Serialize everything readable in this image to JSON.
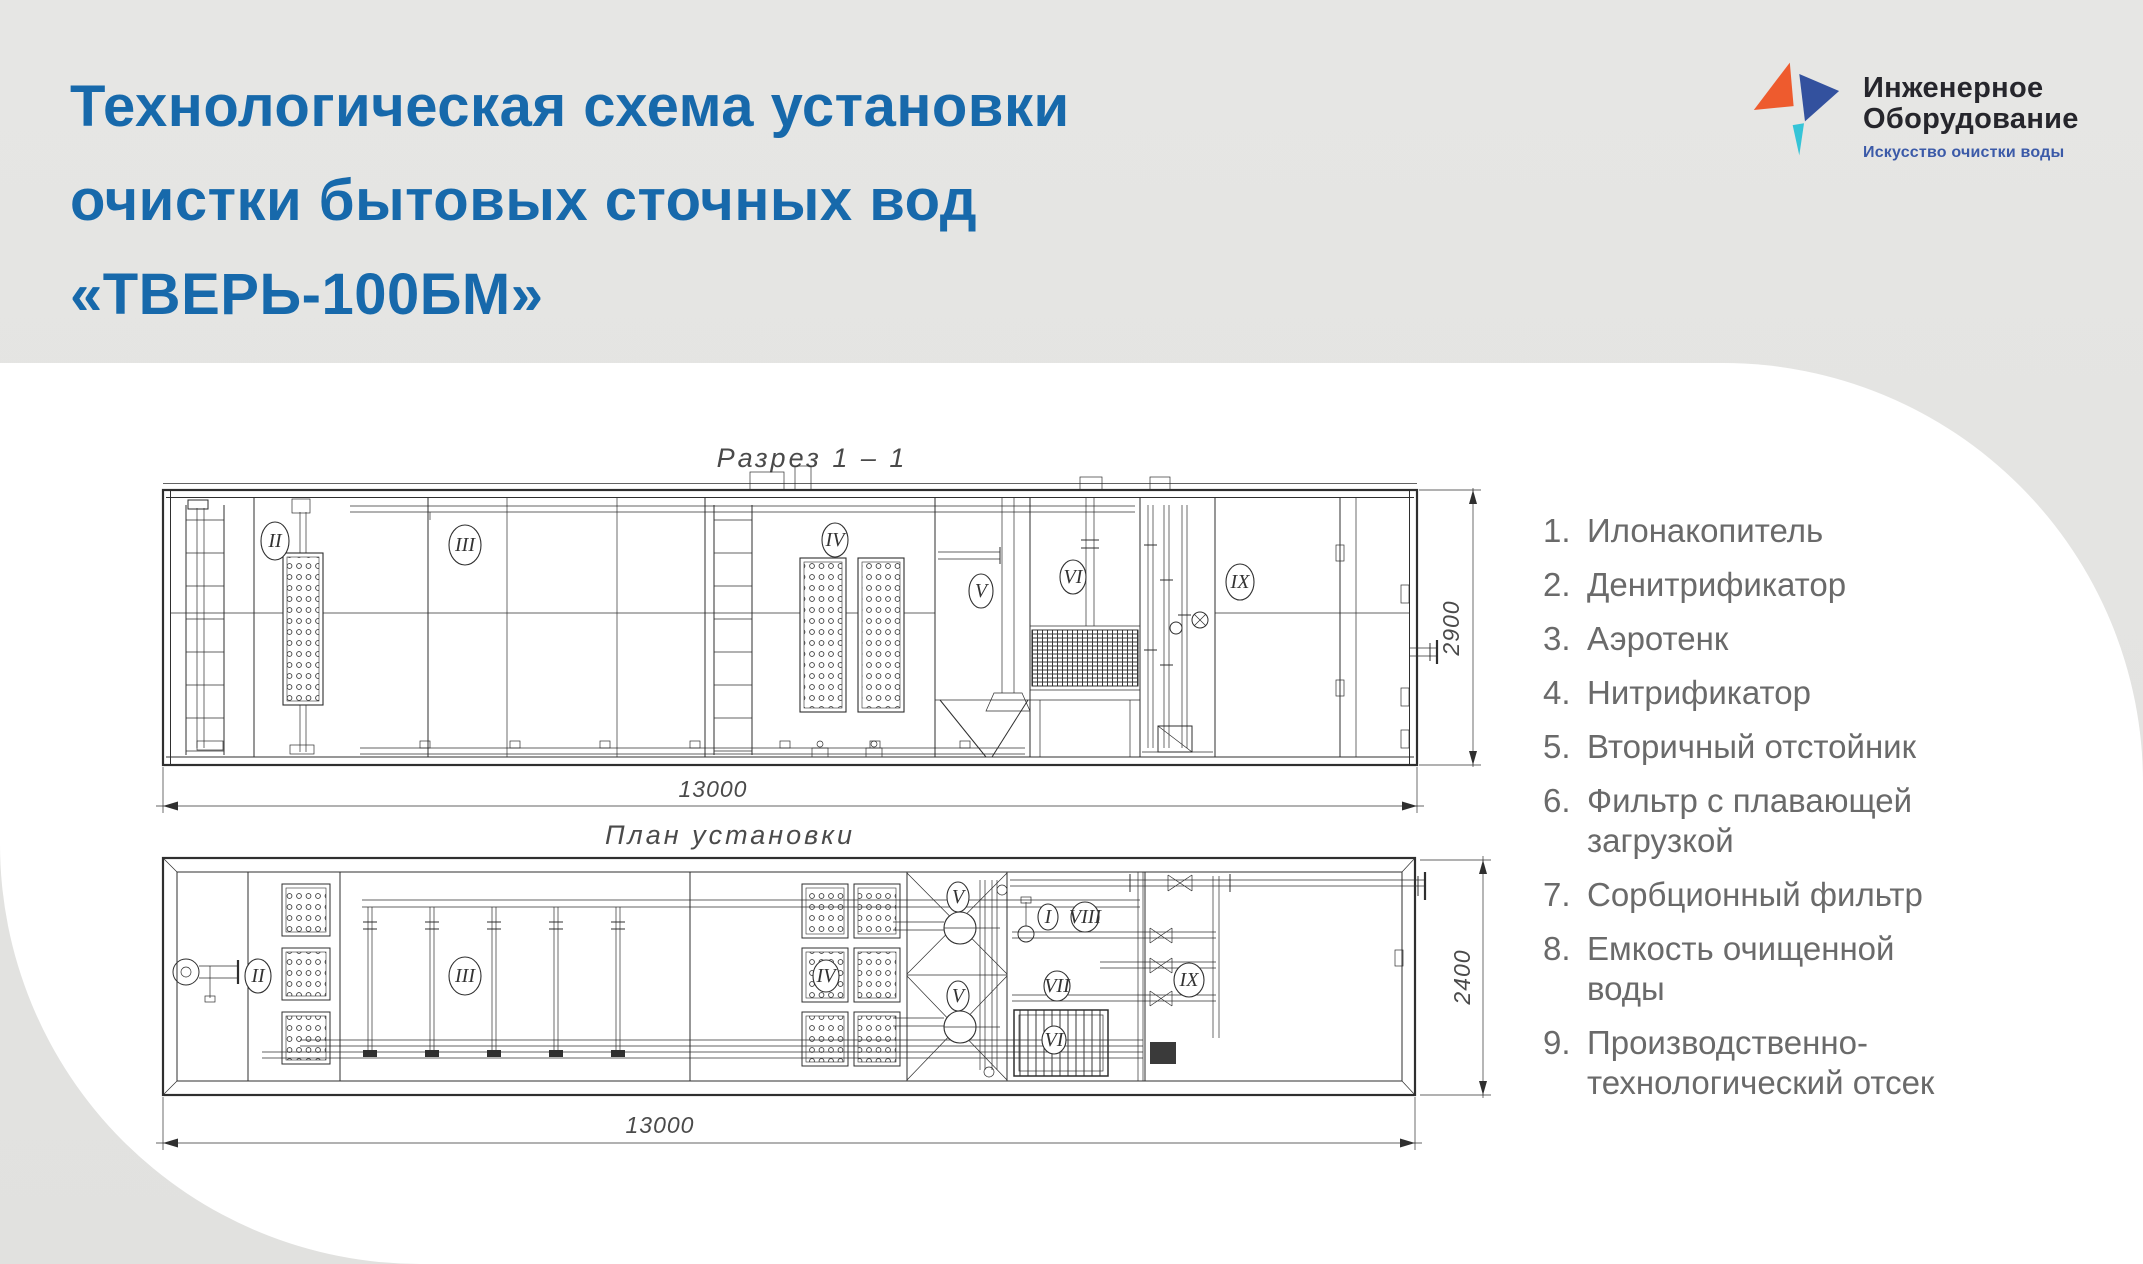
{
  "header": {
    "title_lines": [
      "Технологическая схема установки",
      "очистки бытовых сточных вод",
      "«ТВЕРЬ-100БМ»"
    ],
    "logo": {
      "name_line1": "Инженерное",
      "name_line2": "Оборудование",
      "tagline": "Искусство очистки воды"
    }
  },
  "colors": {
    "title_blue": "#1769ab",
    "logo_orange": "#ee5b2e",
    "logo_navy": "#33519e",
    "logo_teal": "#35c4d7",
    "tagline_blue": "#3b5aa8",
    "legend_gray": "#6a6a6a",
    "background_gray": "#e4e4e2",
    "panel_white": "#ffffff",
    "drawing_line": "#2f2f2f"
  },
  "drawings": {
    "section": {
      "caption": "Разрез 1 – 1",
      "width_dim": "13000",
      "height_dim": "2900",
      "labels": [
        "II",
        "III",
        "IV",
        "V",
        "VI",
        "IX"
      ]
    },
    "plan": {
      "caption": "План установки",
      "width_dim": "13000",
      "height_dim": "2400",
      "labels": [
        "II",
        "III",
        "IV",
        "V",
        "V",
        "I",
        "VIII",
        "VII",
        "VI",
        "IX"
      ]
    }
  },
  "legend": {
    "items": [
      {
        "num": "1.",
        "text": "Илонакопитель"
      },
      {
        "num": "2.",
        "text": "Денитрификатор"
      },
      {
        "num": "3.",
        "text": "Аэротенк"
      },
      {
        "num": "4.",
        "text": "Нитрификатор"
      },
      {
        "num": "5.",
        "text": "Вторичный отстойник"
      },
      {
        "num": "6.",
        "text": "Фильтр с плавающей загрузкой"
      },
      {
        "num": "7.",
        "text": "Сорбционный фильтр"
      },
      {
        "num": "8.",
        "text": "Емкость очищенной воды"
      },
      {
        "num": "9.",
        "text": "Производственно-технологический отсек"
      }
    ]
  }
}
